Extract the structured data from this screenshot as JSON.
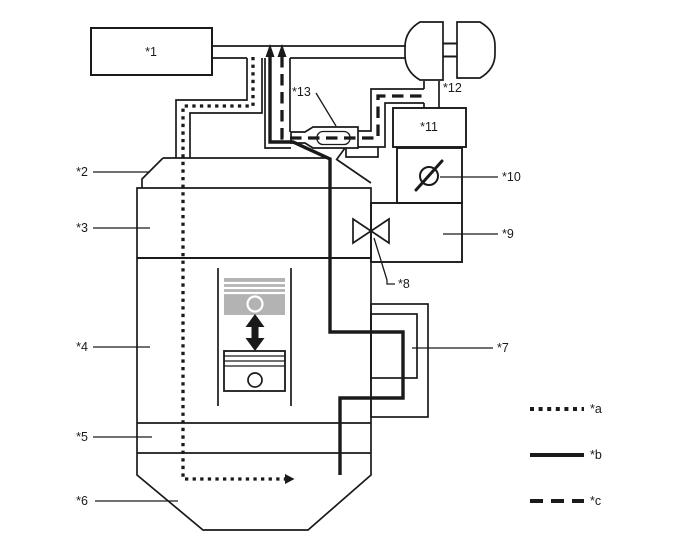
{
  "figure": {
    "type": "engine-blowby-ventilation-schematic",
    "colors": {
      "line": "#1a1a1a",
      "piston": "#b3b3b3",
      "bg": "#ffffff"
    },
    "part_labels": {
      "p1": "*1",
      "p2": "*2",
      "p3": "*3",
      "p4": "*4",
      "p5": "*5",
      "p6": "*6",
      "p7": "*7",
      "p8": "*8",
      "p9": "*9",
      "p10": "*10",
      "p11": "*11",
      "p12": "*12",
      "p13": "*13"
    },
    "legend": [
      {
        "label": "*a",
        "style": "dotted"
      },
      {
        "label": "*b",
        "style": "solid"
      },
      {
        "label": "*c",
        "style": "dashed"
      }
    ]
  }
}
